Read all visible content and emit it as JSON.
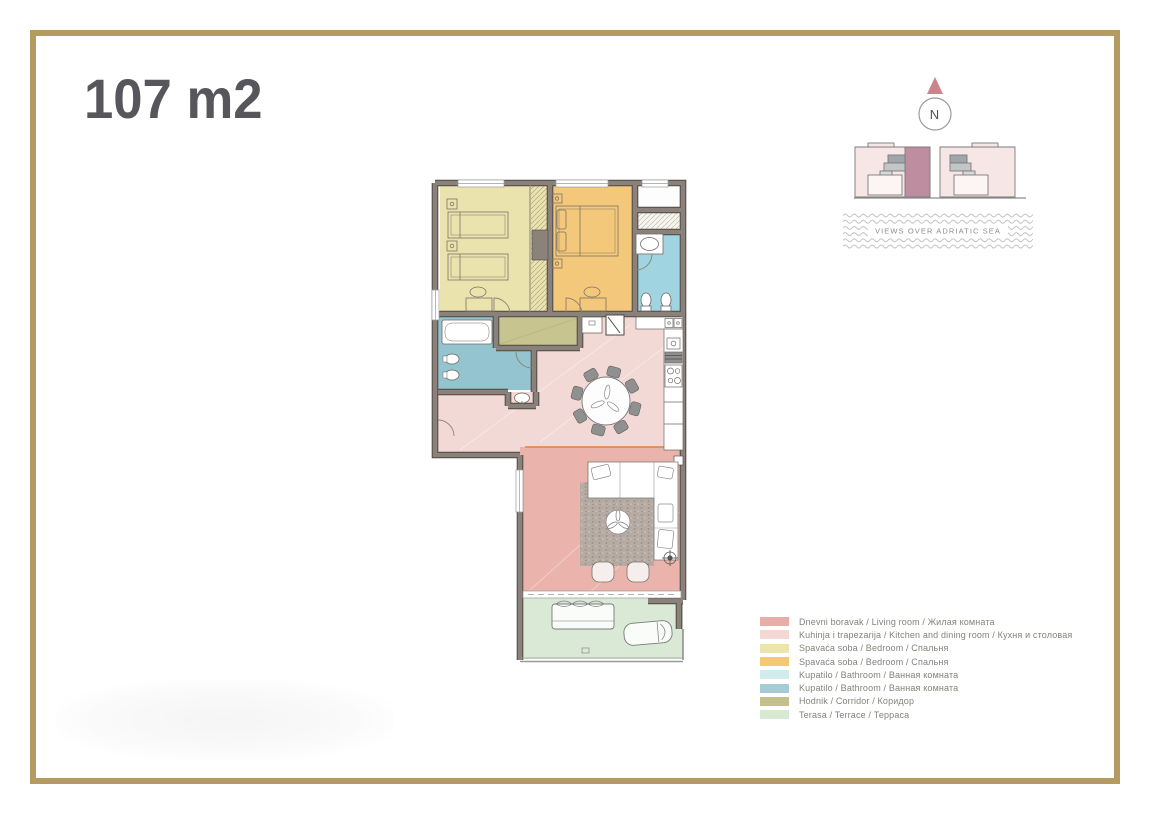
{
  "page": {
    "background": "#ffffff",
    "frame_color": "#b59a62"
  },
  "header": {
    "title": "107 m2",
    "color": "#57565a"
  },
  "compass": {
    "label": "N",
    "triangle_color": "#c9858c"
  },
  "site_plan": {
    "building_color": "#f6e6e5",
    "highlight_color": "#bf8da0"
  },
  "sea_view": {
    "label": "VIEWS OVER ADRIATIC SEA"
  },
  "legend": {
    "items": [
      {
        "id": "living",
        "label": "Dnevni boravak / Living room / Жилая комната",
        "color": "#e7ada6"
      },
      {
        "id": "kitchen-dining",
        "label": "Kuhinja i trapezarija / Kitchen and dining room / Кухня и столовая",
        "color": "#f4d8d3"
      },
      {
        "id": "bedroom-1",
        "label": "Spavaća soba / Bedroom / Спальня",
        "color": "#ece4ad"
      },
      {
        "id": "bedroom-2",
        "label": "Spavaća soba / Bedroom / Спальня",
        "color": "#f5c878"
      },
      {
        "id": "bathroom-1",
        "label": "Kupatilo / Bathroom / Ванная комната",
        "color": "#d2ecee"
      },
      {
        "id": "bathroom-2",
        "label": "Kupatilo / Bathroom / Ванная комната",
        "color": "#a6cbd5"
      },
      {
        "id": "corridor",
        "label": "Hodnik / Corridor / Коридор",
        "color": "#c3c08b"
      },
      {
        "id": "terrace",
        "label": "Terasa / Terrace / Терраса",
        "color": "#d7e8d3"
      }
    ]
  },
  "floor_plan": {
    "room_colors": {
      "living": "#eab4ac",
      "kitchen": "#f3d9d5",
      "bedroom1": "#eae3ae",
      "bedroom2": "#f4c87a",
      "bathroom1": "#a0d4e1",
      "bathroom2": "#94c4cf",
      "corridor": "#c8c48f",
      "terrace": "#d9e9d5"
    },
    "wall_color": "#8a817b",
    "accent_line_color": "#e0813f"
  }
}
